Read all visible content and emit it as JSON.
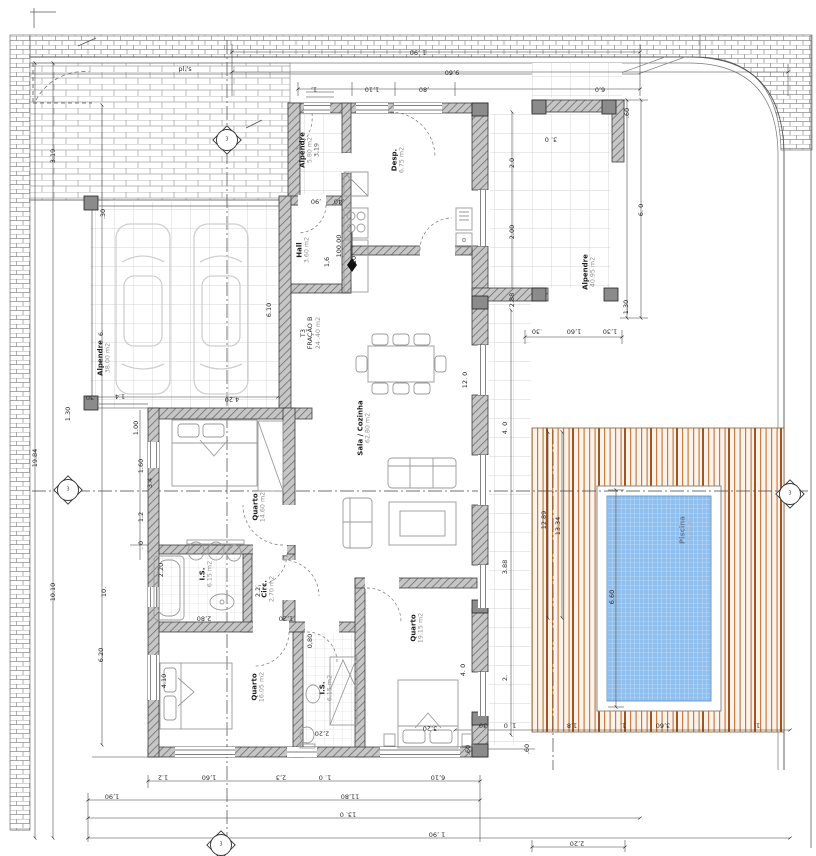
{
  "site": {
    "paving_label": "pl.'s",
    "elevation": "100.00"
  },
  "unit": {
    "type": "T3",
    "fraction": "FRAÇÃO B",
    "area": "24 .40 m2"
  },
  "rooms": [
    {
      "id": "garage",
      "name": "Alpendre",
      "area": "38.00 m2"
    },
    {
      "id": "porch",
      "name": "Alpendre",
      "area": "5.80 m2",
      "extra": "3,19"
    },
    {
      "id": "pantry",
      "name": "Desp.",
      "area": "6.75 m2"
    },
    {
      "id": "hall",
      "name": "Hall",
      "area": "3.60 m2"
    },
    {
      "id": "living-kitchen",
      "name": "Sala / Cozinha",
      "area": "62.80 m2"
    },
    {
      "id": "bedroom1",
      "name": "Quarto",
      "area": "14.60 m2"
    },
    {
      "id": "bath1",
      "name": "I.S.",
      "area": "6.15 m2"
    },
    {
      "id": "circulation",
      "name": "Circ.",
      "area": "2.70 m2"
    },
    {
      "id": "bedroom2",
      "name": "Quarto",
      "area": "16.05 m2"
    },
    {
      "id": "bath2",
      "name": "I.S.",
      "area": "6.15 m2"
    },
    {
      "id": "bedroom3",
      "name": "Quarto",
      "area": "19.15 m2"
    },
    {
      "id": "terrace",
      "name": "Alpendre",
      "area": "40.95 m2"
    },
    {
      "id": "pool",
      "name": "Piscina",
      "area": "23.80 m2"
    }
  ],
  "dims": {
    "top": [
      "1 ,90",
      "9,60",
      "1,",
      "1,10",
      ",80",
      "6,0",
      "3. 0",
      ",90",
      ",40"
    ],
    "left": [
      "19.84",
      "3.19",
      "10.10",
      "1.30",
      ".30",
      "6.",
      ".30",
      "1.4",
      "10.",
      "6.20",
      "1.00",
      "1.60",
      "1.2",
      ". 0",
      "3.4",
      "4.10",
      "2.20",
      "6.10",
      "4.20"
    ],
    "right": [
      ".60",
      "6. 0",
      "1.30",
      "2.0",
      "2.00",
      "2.88",
      ".30",
      "1,60",
      "1,30",
      "12. 0",
      "4. 0",
      "3.88",
      "12.89",
      "13.34",
      "6.60",
      "2.",
      "4. 0",
      "1. 0",
      ".30",
      "1.8",
      "1.",
      "3,60",
      "1.",
      ".60",
      ".60",
      "2,20"
    ],
    "bottom": [
      "1.2",
      "1,60",
      "2,3",
      "1. 0",
      "6,10",
      "1,90",
      "11,80",
      "13. 0",
      "1 ,90"
    ],
    "interior": [
      "2.2",
      "2,80",
      "1,20",
      "0,80",
      "2,20",
      "3,20",
      ".10",
      "1,6"
    ]
  },
  "section_markers": {
    "top": "3",
    "left": "3",
    "right": "3",
    "bottom": "3"
  },
  "colors": {
    "pool_water": "#8FBFEF",
    "deck_slat": "#a1551f",
    "wall_hatch": "#6e6e6e",
    "tile_line": "#c6c6c6",
    "brick_line": "#8e8e8e"
  }
}
